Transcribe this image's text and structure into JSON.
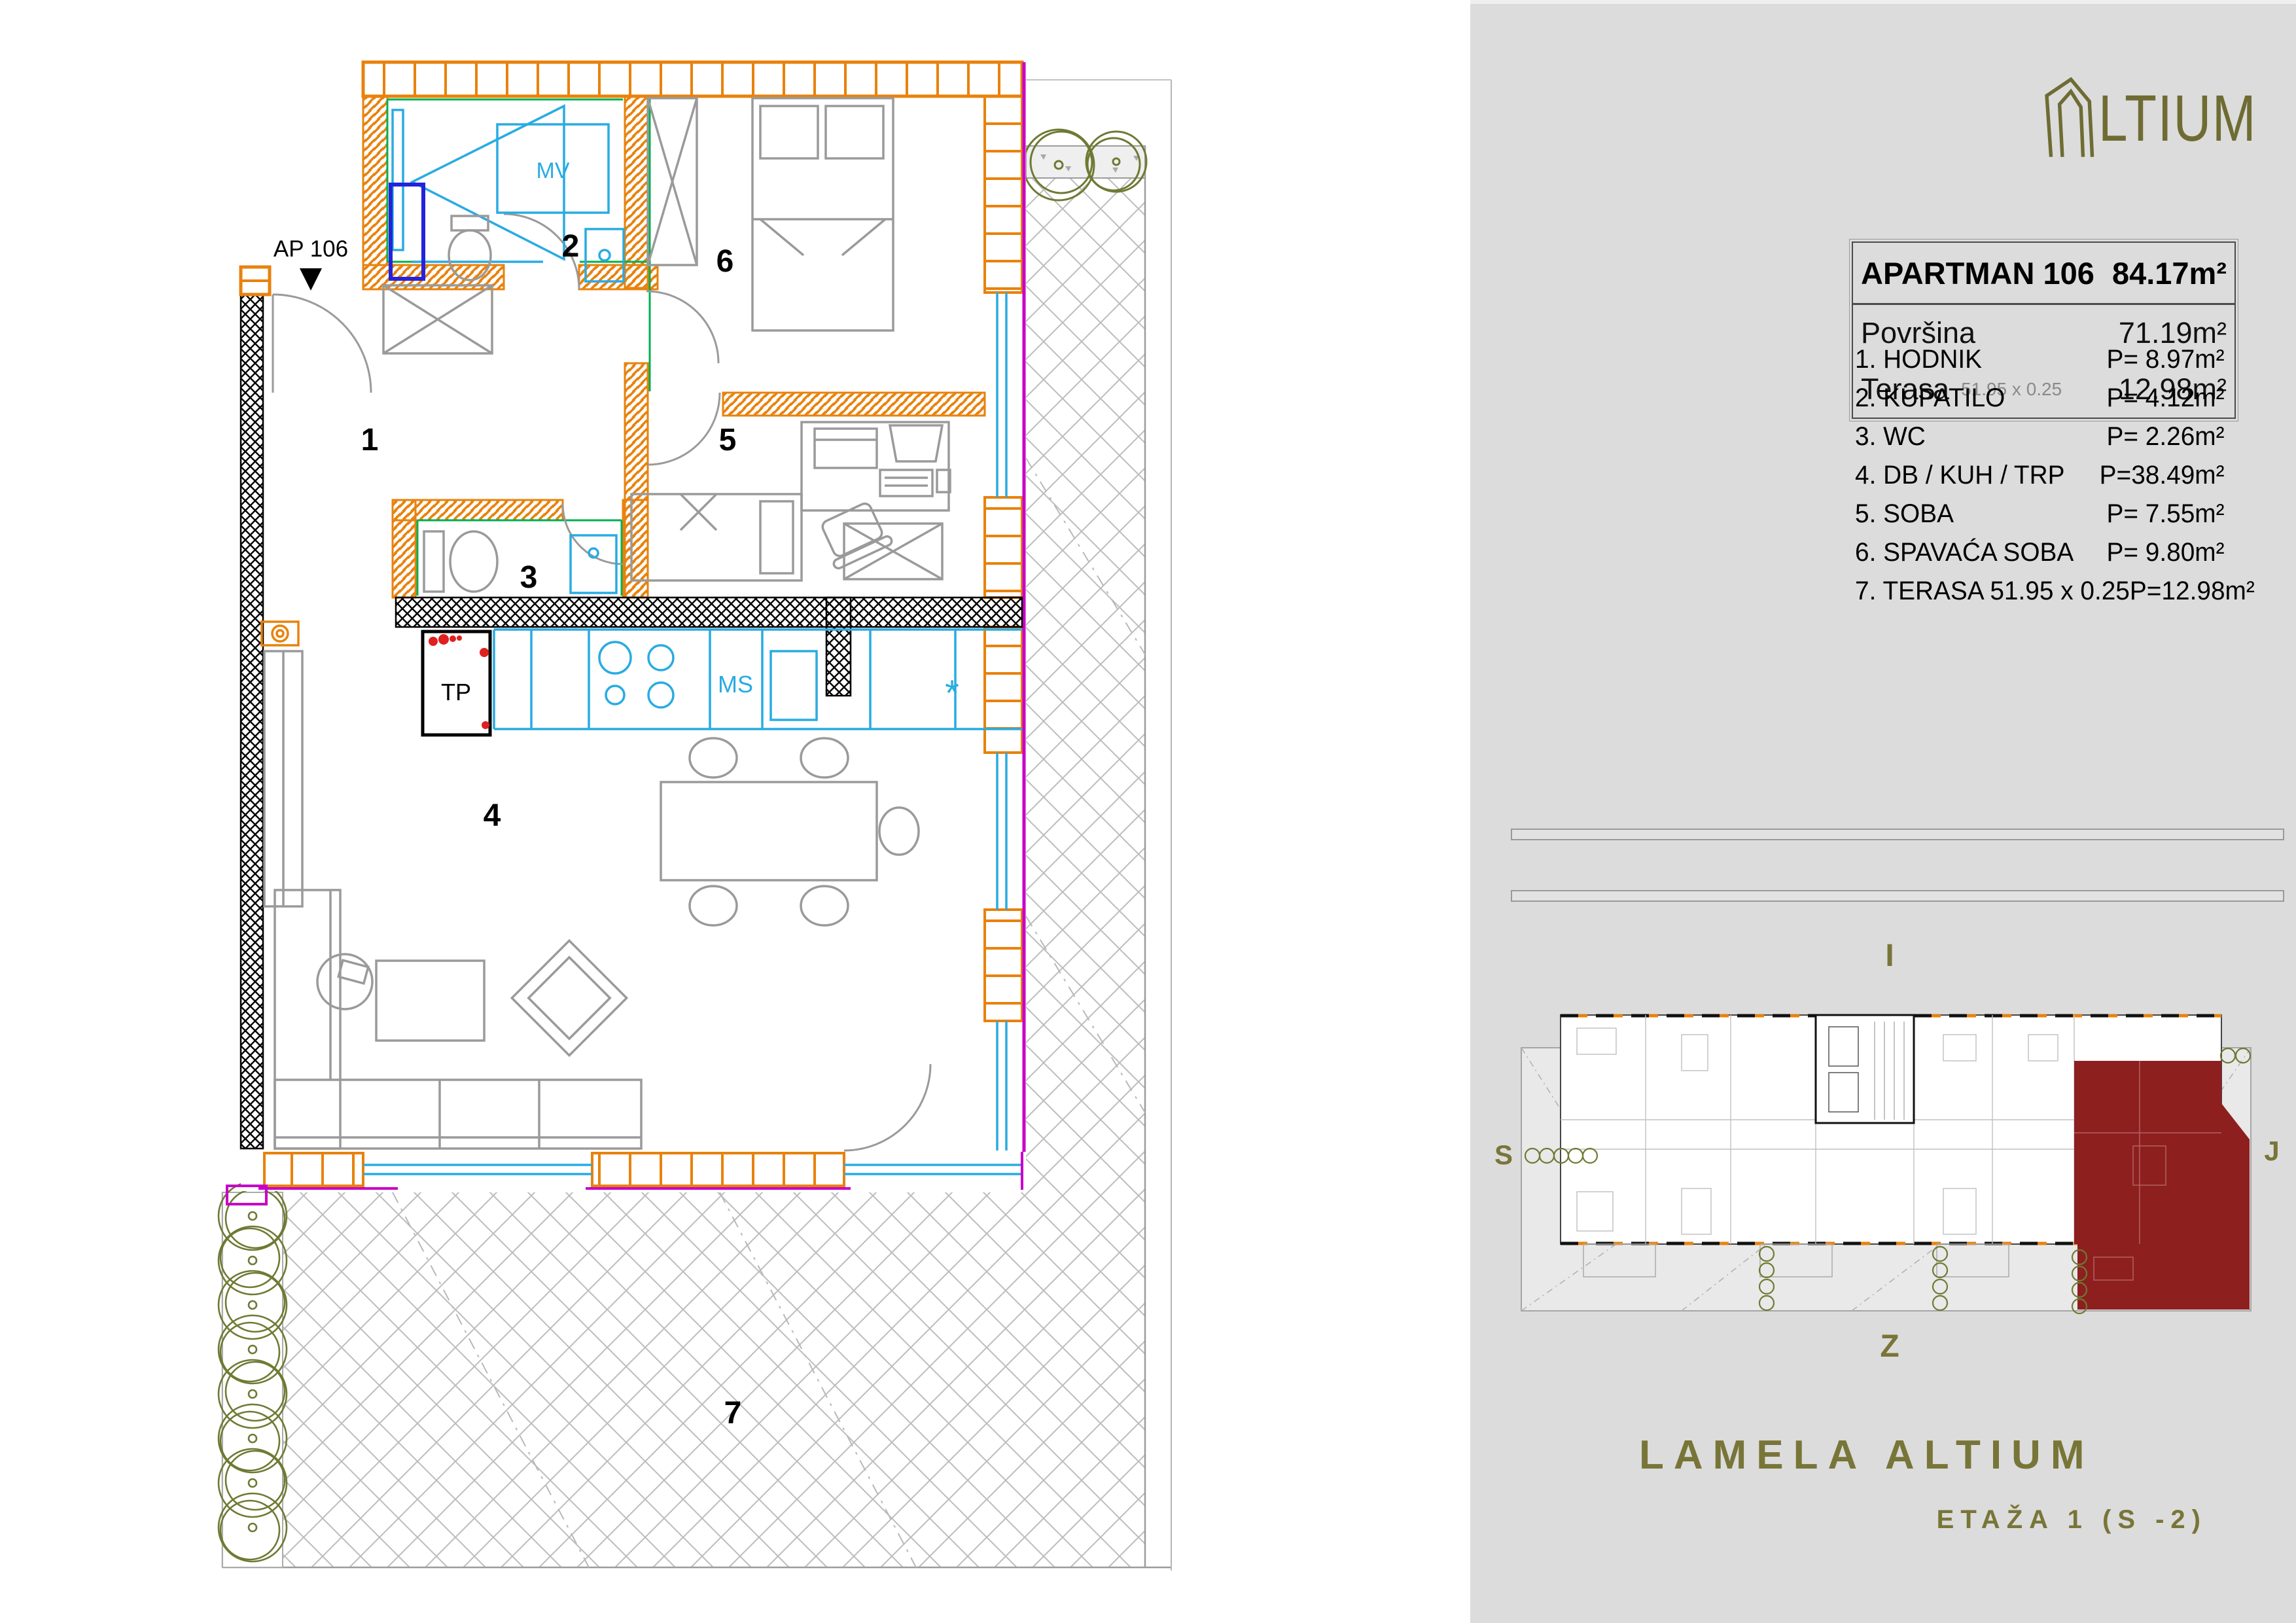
{
  "plan": {
    "marker": "AP 106",
    "room_numbers": {
      "r1": "1",
      "r2": "2",
      "r3": "3",
      "r4": "4",
      "r5": "5",
      "r6": "6",
      "r7": "7"
    },
    "labels": {
      "mv": "MV",
      "tp": "TP",
      "ms": "MS",
      "star": "*"
    }
  },
  "panel": {
    "logo": {
      "text": "LTIUM"
    },
    "unit_table": {
      "title": "APARTMAN 106",
      "title_area": "84.17m²",
      "rows": [
        {
          "label": "Površina",
          "dims": "",
          "value": "71.19m²"
        },
        {
          "label": "Terasa",
          "dims": "51.95 x 0.25",
          "value": "12.98m²"
        }
      ]
    },
    "rooms": [
      {
        "name": "1. HODNIK",
        "area": "P= 8.97m²"
      },
      {
        "name": "2. KUPATILO",
        "area": "P= 4.12m²"
      },
      {
        "name": "3. WC",
        "area": "P= 2.26m²"
      },
      {
        "name": "4. DB / KUH / TRP",
        "area": "P=38.49m²"
      },
      {
        "name": "5. SOBA",
        "area": "P= 7.55m²"
      },
      {
        "name": "6. SPAVAĆA SOBA",
        "area": "P= 9.80m²"
      },
      {
        "name": "7. TERASA 51.95 x 0.25",
        "area": "P=12.98m²"
      }
    ],
    "mini_plan": {
      "compass": {
        "top": "I",
        "left": "S",
        "right": "J",
        "bottom": "Z"
      }
    },
    "footer": {
      "title": "LAMELA ALTIUM",
      "subtitle": "ETAŽA 1 (S -2)"
    }
  },
  "colors": {
    "panel_bg": "#dcdcdc",
    "brand_olive": "#6e6c33",
    "wall_orange": "#e8820d",
    "highlight_red": "#8e1f1f",
    "counter_cyan": "#29abe2",
    "fixture_blue": "#2323dc",
    "inner_green": "#00b050",
    "window_magenta": "#c800c8",
    "tree_olive": "#6e7a33"
  }
}
